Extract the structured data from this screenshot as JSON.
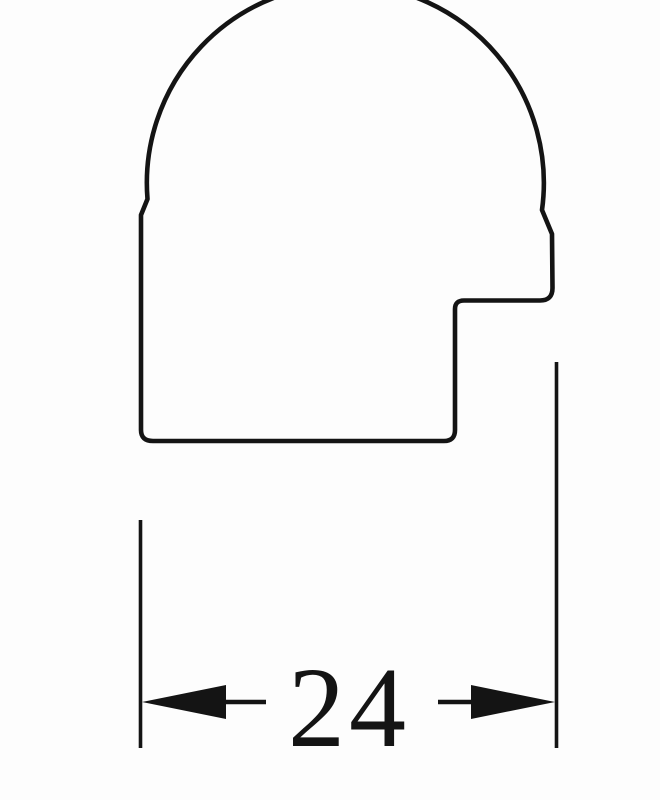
{
  "drawing": {
    "shape": "picture-frame-moulding-profile-cross-section",
    "dimension": {
      "value": "24"
    },
    "colors": {
      "line": "#141414",
      "background": "#fdfdfd",
      "shape_fill": "#fdfdfd"
    }
  }
}
